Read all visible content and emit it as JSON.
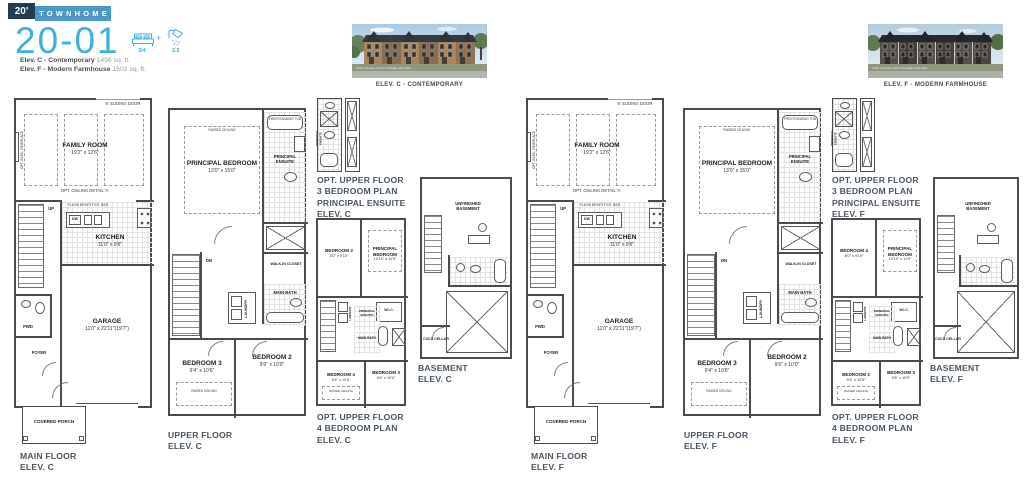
{
  "header": {
    "lot_width": "20'",
    "product_type": "TOWNHOME",
    "model_number": "20-01",
    "bedrooms": "3/4",
    "plus": "+",
    "bathrooms": "2.5",
    "elev_c": {
      "name": "Elev. C - Contemporary",
      "sqft": "1496 sq. ft."
    },
    "elev_f": {
      "name": "Elev. F - Modern Farmhouse",
      "sqft": "1502 sq. ft."
    }
  },
  "renders": {
    "c_caption": "ELEV. C - CONTEMPORARY",
    "f_caption": "ELEV. F - MODERN FARMHOUSE",
    "disclaimer": "Artist Concept. Colour Package May Vary."
  },
  "colors": {
    "accent": "#41aede",
    "banner": "#4b97c8",
    "badge": "#223c52",
    "caption": "#4a5560"
  },
  "rooms": {
    "family_room": {
      "name": "FAMILY ROOM",
      "dims": "19'2\" x 12'6\""
    },
    "kitchen": {
      "name": "KITCHEN",
      "dims": "11'0\" x 9'6\""
    },
    "garage": {
      "name": "GARAGE",
      "dims": "11'0\" x 22'11\"(19'7\")"
    },
    "principal_bedroom": {
      "name": "PRINCIPAL BEDROOM",
      "dims": "13'0\" x 15'0\""
    },
    "bedroom2": {
      "name": "BEDROOM 2",
      "dims": "9'6\" x 10'0\""
    },
    "bedroom3": {
      "name": "BEDROOM 3",
      "dims": "9'4\" x 10'6\""
    },
    "opt4_upper_left_c": {
      "name": "BEDROOM 2",
      "dims": "8'0\" x 9'10\""
    },
    "opt4_upper_left_f": {
      "name": "BEDROOM 4",
      "dims": "8'0\" x 9'10\""
    },
    "opt4_principal": {
      "name": "PRINCIPAL BEDROOM",
      "dims": "10'10\" x 11'9\""
    },
    "opt4_lower_left_c": {
      "name": "BEDROOM 4",
      "dims": "9'4\" x 10'6\""
    },
    "opt4_lower_left_f": {
      "name": "BEDROOM 2",
      "dims": "9'4\" x 10'6\""
    },
    "opt4_lower_right": {
      "name": "BEDROOM 3",
      "dims": "9'6\" x 10'0\""
    },
    "sliding_door": "6' SLIDING DOOR",
    "opt_ceiling": "OPT. CEILING DETAIL 'A'",
    "opt_fireplace": "OPT. ELEC. FIREPLACE",
    "kit_bar": "FLUSH BRKFST KIT. BAR",
    "dw": "DW",
    "up": "UP",
    "dn": "DN",
    "pwd": "PWD",
    "foyer": "FOYER",
    "covered_porch": "COVERED PORCH",
    "raised_ceiling": "RAISED CEILING",
    "principal_ensuite": "PRINCIPAL ENSUITE",
    "freestanding_tub": "FREESTANDING TUB",
    "walk_in_closet": "WALK-IN CLOSET",
    "laundry": "LAUNDRY",
    "main_bath": "MAIN BATH",
    "wic": "W.I.C.",
    "unfinished_basement": "UNFINISHED BASEMENT",
    "cold_cellar": "COLD CELLAR"
  },
  "captions": {
    "main_c": "MAIN FLOOR\nELEV. C",
    "upper_c": "UPPER FLOOR\nELEV. C",
    "opt3_c": "OPT. UPPER FLOOR\n3 BEDROOM PLAN\nPRINCIPAL ENSUITE\nELEV. C",
    "opt4_c": "OPT. UPPER FLOOR\n4 BEDROOM PLAN\nELEV. C",
    "basement_c": "BASEMENT\nELEV. C",
    "main_f": "MAIN FLOOR\nELEV. F",
    "upper_f": "UPPER FLOOR\nELEV. F",
    "opt3_f": "OPT. UPPER FLOOR\n3 BEDROOM PLAN\nPRINCIPAL ENSUITE\nELEV. F",
    "opt4_f": "OPT. UPPER FLOOR\n4 BEDROOM PLAN\nELEV. F",
    "basement_f": "BASEMENT\nELEV. F"
  }
}
